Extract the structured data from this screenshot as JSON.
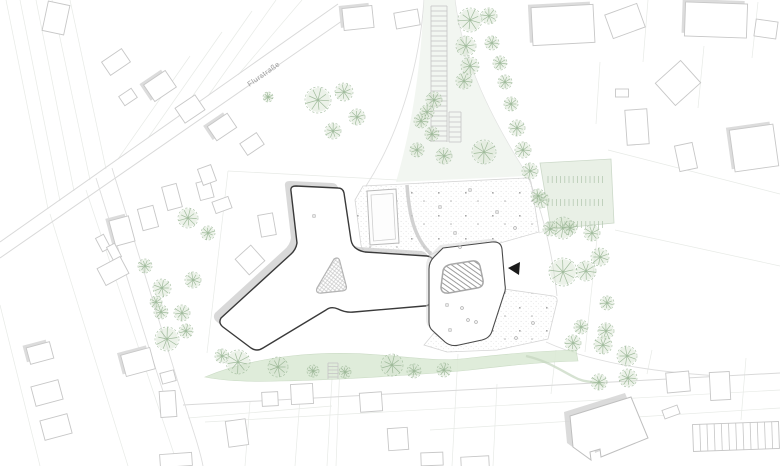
{
  "page": {
    "width": 780,
    "height": 466,
    "background": "#ffffff"
  },
  "labels": {
    "street": "Flurstraße"
  },
  "colors": {
    "tree_green": "#8fae8a",
    "tree_fill": "#d4e3cf",
    "lawn_green": "#dcead6",
    "corridor_tint": "#eff4ed",
    "parking_green": "#e9f0e6",
    "building_outline": "#3a3a3a",
    "context_stroke": "#c7c7c7",
    "shadow_gray": "#c9c9c9",
    "parcel_gray": "#e7eae6",
    "marker_black": "#1b1b1b"
  },
  "site": {
    "main_building": "M 296,186 L 338,188 Q 343,188 344,193 L 351,240 Q 352,246 357,249 Q 360,251 365,252 L 427,256 Q 434,257 434,264 L 431,299 Q 431,306 424,306 L 354,312 Q 346,313 338,309 Q 331,306 326,310 L 263,348 Q 257,352 251,348 L 223,327 Q 218,323 221,318 L 290,255 Q 296,250 297,243 L 291,191 Q 290,186 296,186 Z",
    "central_courtyard": "M 334,259 Q 339,256 340,262 L 346,285 Q 348,291 341,291 L 322,293 Q 315,294 317,288 Z",
    "pavilion": "M 443,248 L 492,242 Q 501,241 502,249 L 505,285 Q 506,290 504,294 L 492,331 Q 490,338 482,340 L 459,345 Q 451,347 445,342 L 433,331 Q 429,328 429,322 L 429,269 Q 429,262 434,257 Z",
    "pavilion_courtyard": "M 453,264 L 472,261 Q 478,260 480,266 L 483,280 Q 484,287 477,288 L 449,293 Q 441,294 441,287 L 443,271 Q 444,265 453,264 Z",
    "upper_plaza": "M 363,186 L 526,178 Q 530,178 531,182 L 539,232 L 500,243 L 445,248 L 428,256 L 368,252 Q 362,251 361,245 L 355,200 Z",
    "lower_plaza": "M 504,289 L 553,296 Q 558,297 557,302 L 548,339 L 497,350 L 447,352 L 424,345 L 434,333 L 445,342 Q 451,347 459,345 L 482,340 Q 490,338 492,331 L 503,294 Z",
    "sports_field": "M 367,191 L 396,189 L 399,243 L 370,245 Z",
    "sports_field_inner": "M 371,195 L 393,193.5 L 395.5,239 L 373.5,241 Z",
    "plaza_wall": "M 407,185 C 409,214 414,238 431,254",
    "pavilion_wall": "M 435,257 L 444,249 L 496,244",
    "ne_parking": "M 540,163 L 611,159 L 614,223 L 551,229 Z",
    "se_building": "M 570,416 L 631,397 L 648,438 L 601,457 L 600,449 L 590,452 L 591,460 L 573,447 Z",
    "corridor_tint_path": "M 424,0 L 455,0 C 462,60 492,120 528,176 L 396,182 C 414,120 421,60 424,0 Z",
    "lawn_strip": "M 205,377 C 255,356 320,350 380,355 C 420,358 440,362 470,358 C 505,354 540,351 576,350 L 578,361 C 540,362 505,366 470,370 C 430,374 340,380 280,381 C 250,382 225,381 205,377 Z",
    "green_path_curve": "M 526,356 C 548,361 560,370 574,377 C 586,384 596,380 604,386"
  },
  "markers": {
    "entrance_triangle": "508,268 520,262 519,275"
  },
  "map": {
    "trees": [
      [
        470,
        20,
        12
      ],
      [
        489,
        16,
        8
      ],
      [
        466,
        46,
        10
      ],
      [
        492,
        43,
        7
      ],
      [
        470,
        66,
        9
      ],
      [
        500,
        63,
        7
      ],
      [
        505,
        82,
        7
      ],
      [
        464,
        81,
        8
      ],
      [
        511,
        104,
        7
      ],
      [
        434,
        100,
        8
      ],
      [
        427,
        112,
        7
      ],
      [
        421,
        121,
        7
      ],
      [
        432,
        134,
        7
      ],
      [
        517,
        128,
        8
      ],
      [
        523,
        150,
        8
      ],
      [
        417,
        150,
        7
      ],
      [
        444,
        156,
        8
      ],
      [
        484,
        152,
        12
      ],
      [
        530,
        171,
        8
      ],
      [
        541,
        200,
        8
      ],
      [
        563,
        228,
        11
      ],
      [
        592,
        233,
        8
      ],
      [
        538,
        196,
        7
      ],
      [
        318,
        100,
        13
      ],
      [
        344,
        92,
        9
      ],
      [
        357,
        117,
        8
      ],
      [
        333,
        131,
        8
      ],
      [
        268,
        97,
        5
      ],
      [
        188,
        218,
        10
      ],
      [
        208,
        233,
        7
      ],
      [
        193,
        280,
        8
      ],
      [
        162,
        288,
        9
      ],
      [
        161,
        312,
        7
      ],
      [
        182,
        313,
        8
      ],
      [
        186,
        331,
        7
      ],
      [
        145,
        266,
        7
      ],
      [
        156,
        302,
        6
      ],
      [
        222,
        356,
        7
      ],
      [
        167,
        339,
        12
      ],
      [
        238,
        362,
        12
      ],
      [
        278,
        367,
        10
      ],
      [
        313,
        371,
        6
      ],
      [
        345,
        372,
        6
      ],
      [
        392,
        365,
        11
      ],
      [
        414,
        371,
        7
      ],
      [
        444,
        370,
        7
      ],
      [
        573,
        343,
        8
      ],
      [
        603,
        345,
        9
      ],
      [
        627,
        356,
        10
      ],
      [
        628,
        378,
        9
      ],
      [
        599,
        382,
        8
      ],
      [
        581,
        327,
        7
      ],
      [
        606,
        331,
        8
      ],
      [
        607,
        303,
        7
      ],
      [
        550,
        229,
        7
      ],
      [
        570,
        228,
        7
      ],
      [
        586,
        271,
        10
      ],
      [
        563,
        272,
        14
      ],
      [
        600,
        257,
        9
      ]
    ],
    "houses": [
      [
        56,
        18,
        22,
        30,
        12,
        0
      ],
      [
        116,
        62,
        24,
        16,
        -34,
        0
      ],
      [
        160,
        86,
        26,
        20,
        -34,
        1
      ],
      [
        128,
        97,
        15,
        11,
        -34,
        0
      ],
      [
        190,
        109,
        24,
        18,
        -34,
        0
      ],
      [
        222,
        127,
        24,
        17,
        -34,
        1
      ],
      [
        252,
        144,
        20,
        14,
        -34,
        0
      ],
      [
        205,
        190,
        14,
        18,
        -15,
        0
      ],
      [
        222,
        205,
        17,
        12,
        -20,
        0
      ],
      [
        172,
        197,
        15,
        24,
        -15,
        0
      ],
      [
        148,
        218,
        16,
        22,
        -15,
        0
      ],
      [
        122,
        231,
        20,
        26,
        -15,
        1
      ],
      [
        103,
        243,
        9,
        15,
        -28,
        0
      ],
      [
        114,
        252,
        9,
        15,
        -28,
        0
      ],
      [
        113,
        271,
        26,
        19,
        -28,
        0
      ],
      [
        267,
        225,
        15,
        22,
        -10,
        0
      ],
      [
        250,
        260,
        21,
        21,
        -42,
        0
      ],
      [
        207,
        175,
        14,
        17,
        -20,
        0
      ],
      [
        358,
        18,
        30,
        22,
        -6,
        1
      ],
      [
        407,
        19,
        24,
        16,
        -10,
        0
      ],
      [
        563,
        25,
        62,
        38,
        -3,
        1
      ],
      [
        625,
        21,
        34,
        25,
        -20,
        0
      ],
      [
        716,
        20,
        62,
        34,
        2,
        1
      ],
      [
        766,
        29,
        22,
        17,
        8,
        0
      ],
      [
        678,
        83,
        34,
        30,
        -42,
        0
      ],
      [
        622,
        93,
        13,
        8,
        0,
        0
      ],
      [
        637,
        127,
        22,
        35,
        -4,
        0
      ],
      [
        686,
        157,
        18,
        26,
        -12,
        0
      ],
      [
        754,
        148,
        44,
        42,
        -8,
        1
      ],
      [
        40,
        353,
        24,
        17,
        -15,
        1
      ],
      [
        47,
        393,
        28,
        20,
        -15,
        0
      ],
      [
        56,
        427,
        28,
        20,
        -15,
        0
      ],
      [
        138,
        362,
        30,
        22,
        -15,
        1
      ],
      [
        168,
        377,
        14,
        11,
        -15,
        0
      ],
      [
        168,
        404,
        16,
        26,
        -4,
        0
      ],
      [
        237,
        433,
        20,
        26,
        -8,
        0
      ],
      [
        176,
        460,
        32,
        13,
        -4,
        0
      ],
      [
        270,
        399,
        16,
        14,
        -3,
        0
      ],
      [
        302,
        394,
        22,
        20,
        -3,
        0
      ],
      [
        371,
        402,
        22,
        19,
        -4,
        0
      ],
      [
        398,
        439,
        20,
        22,
        -4,
        0
      ],
      [
        432,
        459,
        22,
        13,
        -2,
        0
      ],
      [
        475,
        462,
        28,
        11,
        -3,
        0
      ],
      [
        678,
        382,
        23,
        20,
        -5,
        0
      ],
      [
        720,
        386,
        20,
        28,
        -3,
        0
      ],
      [
        671,
        412,
        16,
        9,
        -20,
        0
      ]
    ],
    "parcel_lines": [
      [
        6,
        0,
        48,
        209
      ],
      [
        20,
        0,
        60,
        201
      ],
      [
        36,
        0,
        74,
        191
      ],
      [
        52,
        0,
        90,
        180
      ],
      [
        70,
        0,
        106,
        169
      ],
      [
        118,
        159,
        190,
        56
      ],
      [
        148,
        138,
        222,
        32
      ],
      [
        178,
        117,
        252,
        11
      ],
      [
        208,
        96,
        276,
        0
      ],
      [
        238,
        75,
        302,
        0
      ],
      [
        50,
        214,
        128,
        466
      ],
      [
        86,
        190,
        178,
        466
      ],
      [
        0,
        305,
        40,
        466
      ],
      [
        648,
        0,
        643,
        62
      ],
      [
        704,
        46,
        698,
        108
      ],
      [
        758,
        2,
        752,
        58
      ],
      [
        600,
        62,
        596,
        124
      ],
      [
        608,
        150,
        780,
        194
      ],
      [
        615,
        230,
        780,
        266
      ],
      [
        250,
        402,
        245,
        466
      ],
      [
        300,
        398,
        295,
        466
      ],
      [
        458,
        354,
        452,
        466
      ],
      [
        497,
        384,
        493,
        466
      ],
      [
        556,
        350,
        551,
        394
      ],
      [
        652,
        350,
        647,
        374
      ],
      [
        746,
        358,
        741,
        420
      ],
      [
        430,
        430,
        780,
        408
      ],
      [
        188,
        418,
        332,
        406
      ],
      [
        205,
        422,
        780,
        390
      ],
      [
        333,
        362,
        327,
        466
      ],
      [
        340,
        362,
        336,
        466
      ],
      [
        228,
        171,
        398,
        180
      ],
      [
        228,
        171,
        207,
        353
      ],
      [
        539,
        233,
        606,
        210
      ],
      [
        600,
        210,
        585,
        352
      ]
    ],
    "road_lines": [
      [
        338,
        4,
        0,
        242
      ],
      [
        352,
        14,
        0,
        258
      ],
      [
        183,
        405,
        780,
        373
      ]
    ],
    "road_curves": [
      "M 424,0 C 420,60 402,130 366,186",
      "M 455,0 C 462,60 492,120 528,176",
      "M 112,168 C 140,260 165,340 185,405 C 193,430 200,450 203,466",
      "M 96,178 C 124,266 148,348 170,412",
      "M 528,177 C 543,212 552,250 557,296",
      "M 546,342 C 590,362 650,372 720,376"
    ],
    "ladders": [
      {
        "x1": 431,
        "x2": 447,
        "y1": 6,
        "y2": 142,
        "step": 5
      },
      {
        "x1": 449,
        "x2": 461,
        "y1": 112,
        "y2": 142,
        "step": 5
      },
      {
        "x1": 328,
        "x2": 338,
        "y1": 363,
        "y2": 379,
        "step": 3.5
      }
    ],
    "ne_parking_rows": [
      {
        "y": 176,
        "h": 7
      },
      {
        "y": 199,
        "h": 7
      },
      {
        "y": 221,
        "h": 7
      }
    ],
    "ne_parking_x": {
      "from": 548,
      "to": 606,
      "step": 4.2
    },
    "se_parking": {
      "x": 693,
      "y": 423,
      "w": 86,
      "h": 27,
      "step": 7.2,
      "rot": -2,
      "cx": 736,
      "cy": 437
    },
    "marks": [
      [
        314,
        216,
        "s"
      ],
      [
        447,
        305,
        "s"
      ],
      [
        450,
        330,
        "s"
      ],
      [
        462,
        308,
        "c"
      ],
      [
        468,
        320,
        "c"
      ],
      [
        476,
        322,
        "c"
      ],
      [
        455,
        233,
        "s"
      ],
      [
        470,
        190,
        "s"
      ],
      [
        440,
        207,
        "s"
      ],
      [
        497,
        212,
        "s"
      ],
      [
        515,
        228,
        "c"
      ],
      [
        460,
        247,
        "c"
      ],
      [
        533,
        323,
        "c"
      ],
      [
        516,
        338,
        "c"
      ]
    ]
  }
}
